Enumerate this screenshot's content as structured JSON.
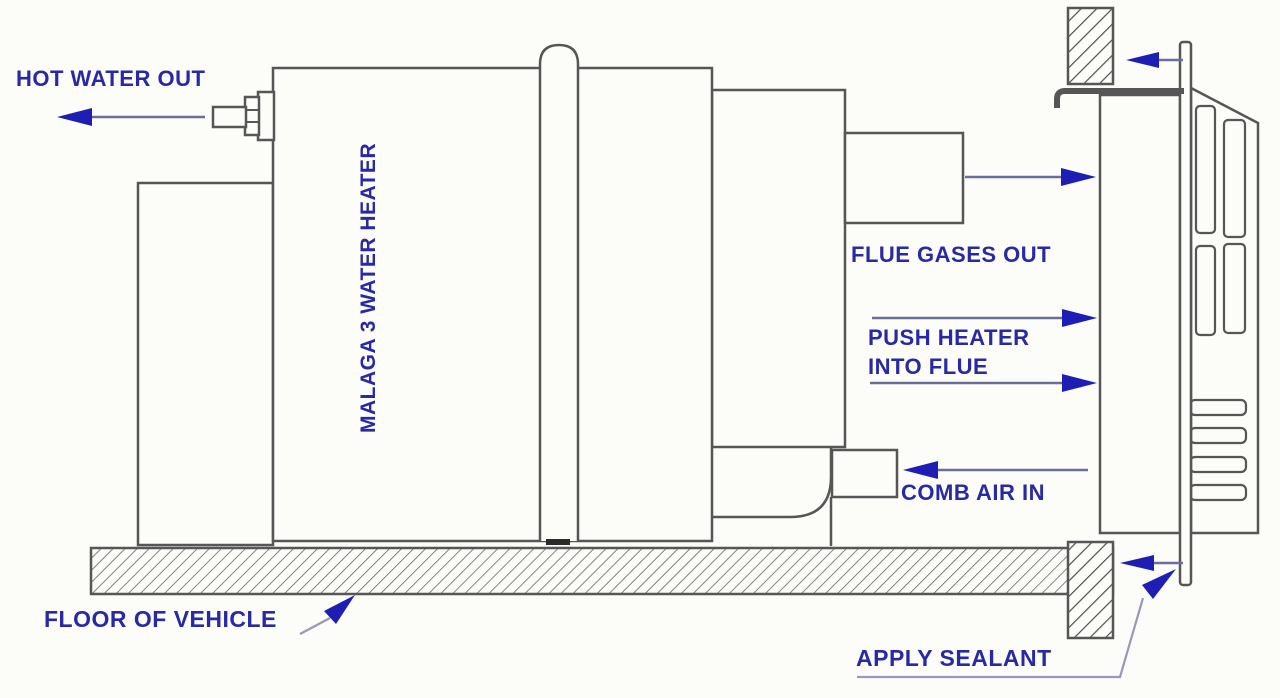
{
  "diagram": {
    "title": "Malaga 3 water heater flue installation diagram",
    "labels": {
      "hot_water_out": "HOT WATER OUT",
      "heater_name": "MALAGA 3 WATER HEATER",
      "flue_gases_out": "FLUE GASES OUT",
      "push_heater": "PUSH HEATER INTO FLUE",
      "comb_air_in": "COMB AIR IN",
      "floor_of_vehicle": "FLOOR OF VEHICLE",
      "apply_sealant": "APPLY SEALANT"
    },
    "colors": {
      "label_text": "#2929a3",
      "arrow_head": "#1e1eb4",
      "arrow_shaft": "#6d6d99",
      "leader_line": "#9898bb",
      "outline": "#565656",
      "background": "#fcfcf9"
    }
  }
}
